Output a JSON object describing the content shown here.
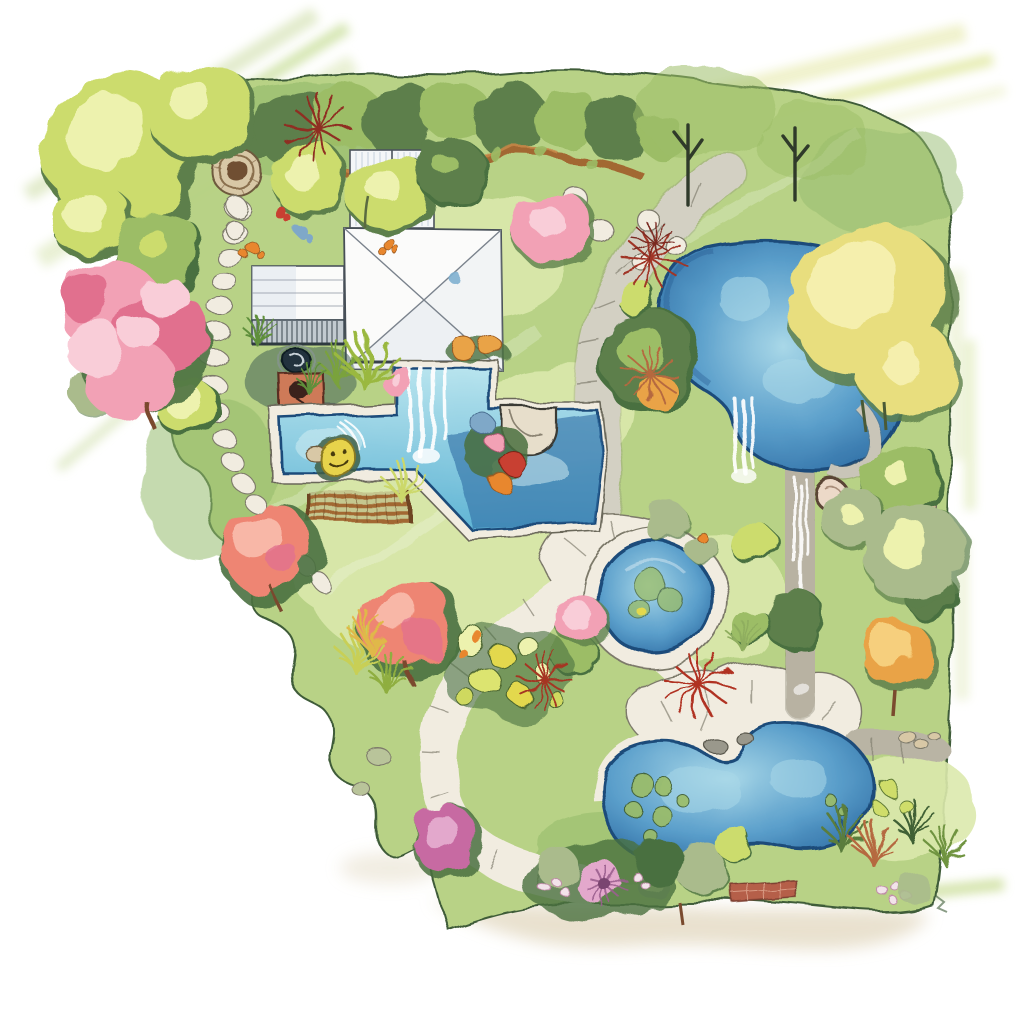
{
  "document": {
    "type": "landscape garden design plan",
    "style": "watercolor illustration",
    "view": "top-down site plan",
    "background": "white paper with loose watercolor washes bleeding at the edges"
  },
  "palette": {
    "paper": "#ffffff",
    "shadow": "#e5dcc6",
    "lawn_light": "#dce9ad",
    "lawn_mid": "#b7d284",
    "lawn_dark": "#93ba6b",
    "green_deep": "#4a7040",
    "ink_green": "#3c5a35",
    "foliage_lime": "#ccdc6d",
    "foliage_lime_light": "#edf2ae",
    "foliage_green": "#9cbd66",
    "foliage_sage": "#aabb8c",
    "foliage_dark": "#5d7f4b",
    "foliage_yellow": "#e8de7e",
    "foliage_yellow_light": "#f5efad",
    "tree_orange": "#e9a346",
    "tree_orange_light": "#f6cf7d",
    "pink_blossom": "#f2a1b5",
    "pink_light": "#f9cdd8",
    "pink_deep": "#e1708e",
    "coral": "#ee8573",
    "coral_light": "#f8b7a7",
    "magenta": "#c76ba2",
    "magenta_light": "#e3a8cc",
    "red_accent": "#b33225",
    "rust": "#b5693f",
    "orange_flower": "#e8872f",
    "blue_flower": "#7fa8c8",
    "water_light": "#a9d8e8",
    "water_mid": "#5b9fcb",
    "water_deep": "#2e6da4",
    "water_ink": "#1d4c7a",
    "pool_light": "#b8e4ee",
    "pool_mid": "#5fb4d4",
    "stone_light": "#f1ece0",
    "stone_mid": "#d9d2c0",
    "stone_gray": "#b9b4a4",
    "stone_ink": "#7d7a6b",
    "stone_warm": "#d8c8a6",
    "terracotta": "#ce7a59",
    "wood_brown": "#a26830",
    "brick": "#b55f49",
    "roof_white": "#fbfbfa",
    "roof_shade": "#dfe5ec",
    "roof_ink": "#4b535c",
    "deck_slat": "#3d4a52",
    "yellow_float": "#e7d34c"
  },
  "features": {
    "house": "house with white hip roof, side wing, roof deck and boardwalk",
    "courtyard": "courtyard with round fire pit, terracotta barbecue pad and spiky yuccas",
    "water": {
      "swimming_pool": "L-shaped swimming pool with deck waterfall, rounded spa steps and yellow smiley float",
      "upper_pond": "large natural pond with waterfall outlet",
      "stream": "stone-edged cascading stream channel",
      "reflecting_pond": "round stone-rimmed reflecting pond with lily pads",
      "lower_pond": "kidney-shaped pond with lily pads and boulders"
    },
    "circulation": {
      "main_path": "wide winding flagstone path",
      "stepping_path": "stepping-stone path from round patio",
      "terraces": "flagstone terraces beside the ponds",
      "brick_path": "short brick path segment"
    },
    "planting": {
      "hedge": "clipped hedge row with curved timber raised bed",
      "trees": "lime-green, yellow, orange, pink-blossom and coral trees",
      "shrubs": "pink, magenta, sage and blue flowering shrubs",
      "accents": "red cordylines, ornamental grasses, orange flowers, purple dahlia, water-lily bed",
      "lawn": "lawn in light and mid greens"
    },
    "ornaments": "circular stone patio, round paver stones, stone ring ornament, pebbles and bench pergola"
  }
}
